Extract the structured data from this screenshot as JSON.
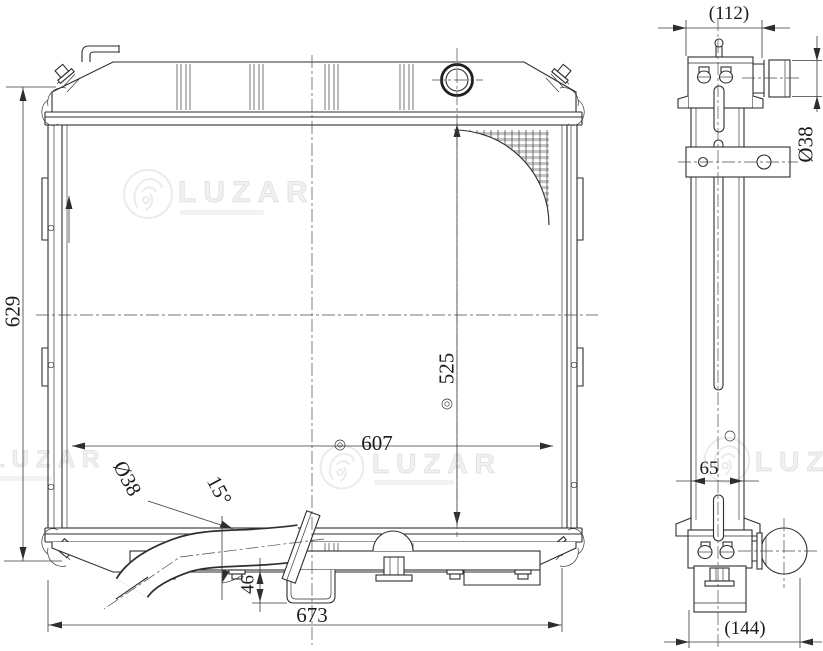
{
  "watermark": {
    "brand": "LUZAR"
  },
  "labels": {
    "front": {
      "height": "629",
      "width": "673",
      "hole_spacing_horizontal": "607",
      "hole_spacing_vertical": "525",
      "outlet_diameter": "Ø38",
      "outlet_angle": "15°",
      "bracket_depth": "46"
    },
    "side": {
      "top_depth_ref": "(112)",
      "inlet_diameter": "Ø38",
      "core_depth": "65",
      "bottom_depth_ref": "(144)"
    }
  }
}
